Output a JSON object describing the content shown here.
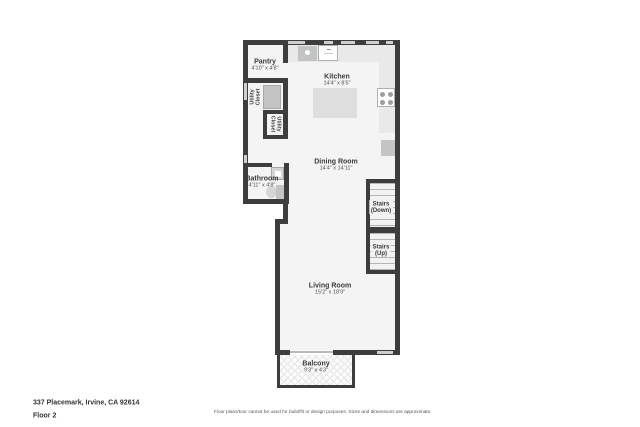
{
  "rooms": {
    "pantry": {
      "name": "Pantry",
      "dims": "4'10\" x 4'8\""
    },
    "kitchen": {
      "name": "Kitchen",
      "dims": "14'4\" x 8'5\""
    },
    "utility_closet_a": {
      "name_line1": "Utility",
      "name_line2": "Closet"
    },
    "utility_closet_b": {
      "name_line1": "Utility",
      "name_line2": "Closet"
    },
    "bathroom": {
      "name": "Bathroom",
      "dims": "4'11\" x 4'8\""
    },
    "dining_room": {
      "name": "Dining Room",
      "dims": "14'4\" x 14'11\""
    },
    "stairs_down": {
      "name": "Stairs",
      "sub": "(Down)"
    },
    "stairs_up": {
      "name": "Stairs",
      "sub": "(Up)"
    },
    "living_room": {
      "name": "Living Room",
      "dims": "15'2\" x 18'9\""
    },
    "balcony": {
      "name": "Balcony",
      "dims": "9'3\" x 4'3\""
    }
  },
  "footer": {
    "address": "337 Placemark, Irvine, CA 92614",
    "floor_label": "Floor 2",
    "disclaimer": "Floor plans/tour cannot be used for build/fit or design purposes. Sizes and dimensions are approximate."
  },
  "colors": {
    "wall": "#3d3d3d",
    "room_fill": "#f4f4f4",
    "counter": "#e9e9e9",
    "appliance": "#c2c5c4",
    "window": "#cfcfcf",
    "text": "#3a3a3a"
  }
}
